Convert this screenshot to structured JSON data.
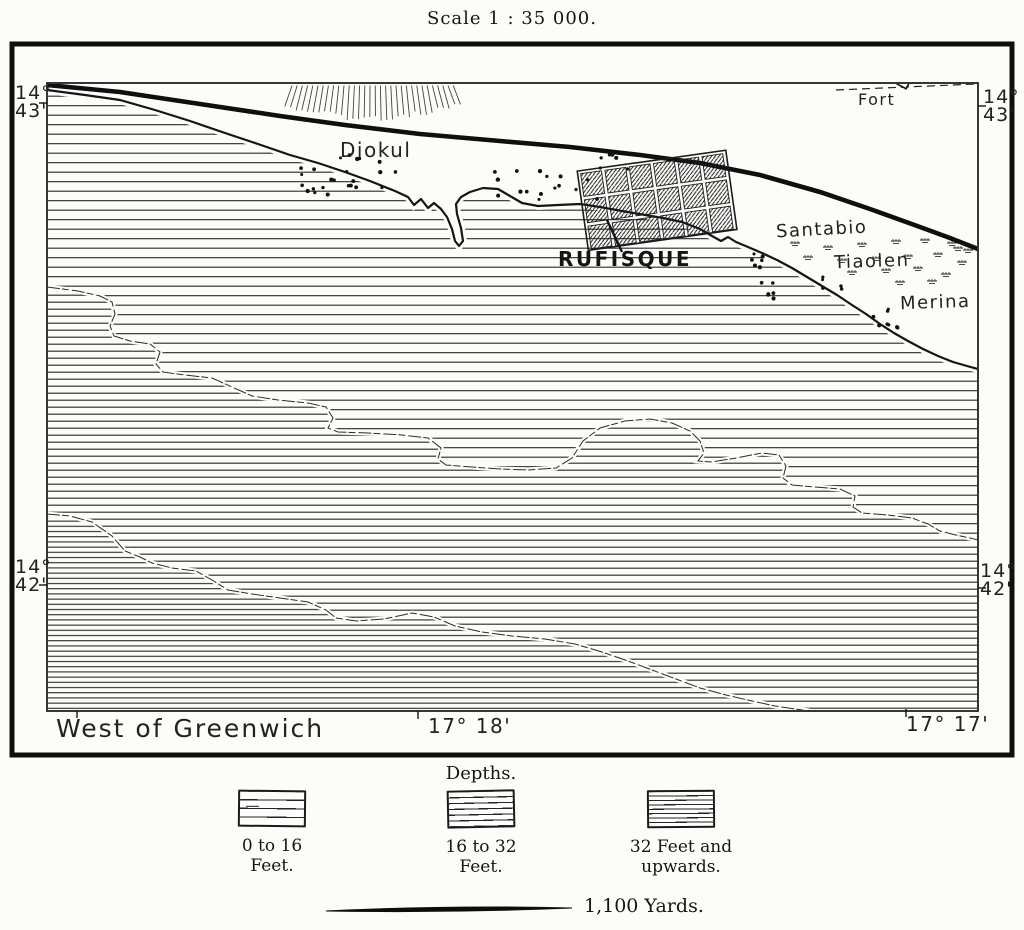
{
  "header": {
    "scale_label": "Scale 1 : 35 000."
  },
  "graticule": {
    "lat_top": {
      "deg": "14°",
      "min": "43'"
    },
    "lat_mid": {
      "deg": "14°",
      "min": "42'"
    },
    "meridian_note": "West of Greenwich",
    "lon_left": "17° 18'",
    "lon_right": "17° 17'"
  },
  "places": {
    "diokul": "Diokul",
    "rufisque": "RUFISQUE",
    "fort": "Fort",
    "santabio": "Santabio",
    "tiaolen": "Tiaolen",
    "merina": "Merina"
  },
  "legend": {
    "title": "Depths.",
    "items": [
      {
        "line1": "0 to 16",
        "line2": "Feet."
      },
      {
        "line1": "16 to 32",
        "line2": "Feet."
      },
      {
        "line1": "32 Feet and",
        "line2": "upwards."
      }
    ]
  },
  "scale_bar": {
    "label": "1,100 Yards."
  },
  "colors": {
    "ink": "#1b1b1b",
    "paper": "#fcfcf9"
  }
}
